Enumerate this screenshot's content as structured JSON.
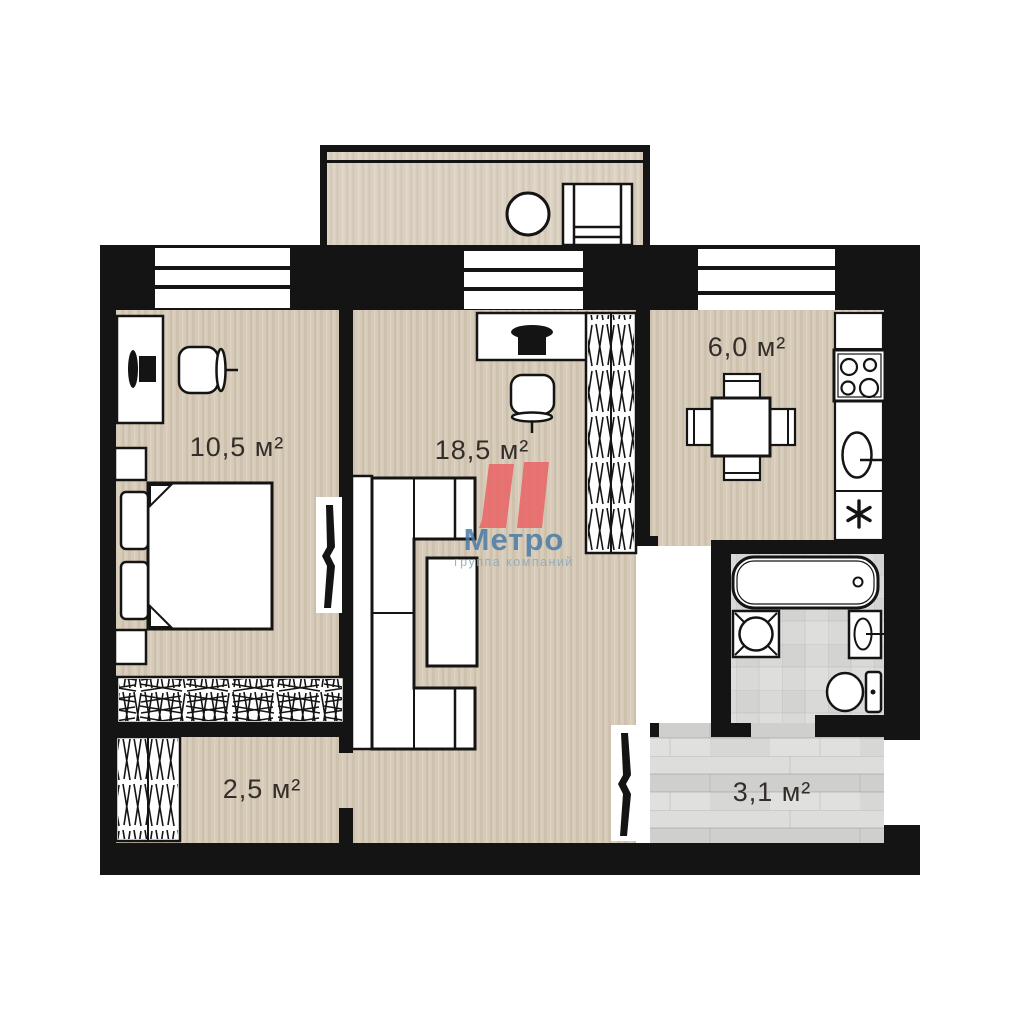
{
  "plan": {
    "type": "apartment-floor-plan",
    "rooms": [
      {
        "id": "bedroom",
        "area_label": "10,5 м²"
      },
      {
        "id": "living",
        "area_label": "18,5 м²"
      },
      {
        "id": "kitchen",
        "area_label": "6,0 м²"
      },
      {
        "id": "hallway",
        "area_label": "2,5 м²"
      },
      {
        "id": "entry",
        "area_label": "3,1 м²"
      }
    ],
    "logo": {
      "name": "Метро",
      "subtitle": "группа компаний",
      "mark_color": "#e96a6a",
      "name_color": "#4a7ba6",
      "subtitle_color": "#8ba6be"
    },
    "colors": {
      "wall": "#141414",
      "floor_wood": "#d6cab8",
      "floor_tile": "#d9d9d7",
      "floor_plank": "#d7d7d5",
      "furniture_fill": "#ffffff",
      "line": "#141414",
      "label": "#332e29"
    }
  }
}
